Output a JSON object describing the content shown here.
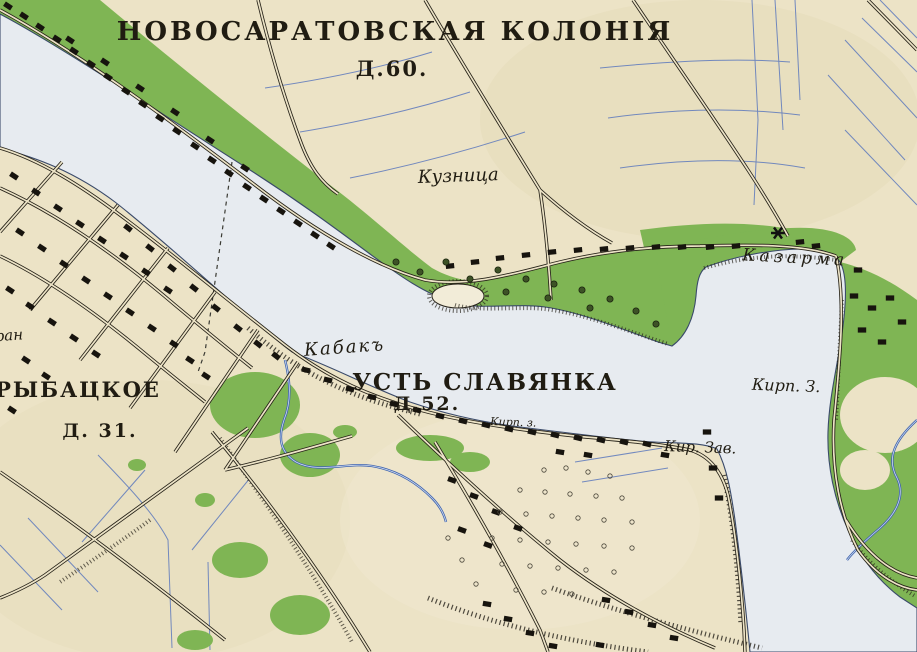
{
  "map": {
    "type": "historical-topographic-map",
    "labels": {
      "novosaratovskaya": "НОВОСАРАТОВСКАЯ КОЛОНІЯ",
      "d60": "Д.60.",
      "kuznitsa": "Кузница",
      "kazarma": "Казарма",
      "kabak": "Кабакъ",
      "ust_slavyanka": "УСТЬ СЛАВЯНКА",
      "d52": "Д.52.",
      "kirp_small": "Кирп. з.",
      "kir_zav": "Кир. Зав.",
      "kirp_z": "Кирп. З.",
      "rybatskoe": "РЫБАЦКОЕ",
      "d31": "Д. 31.",
      "partial_left_edge": "аран"
    },
    "colors": {
      "paper": "#ece3c6",
      "water_fill": "#e7ebf0",
      "water_waves": "#8aa2c9",
      "meadow_green": "#7fb554",
      "ink": "#201c12",
      "field_ditch_blue": "#5d79bd",
      "shoreline": "#3a4a6a"
    }
  }
}
